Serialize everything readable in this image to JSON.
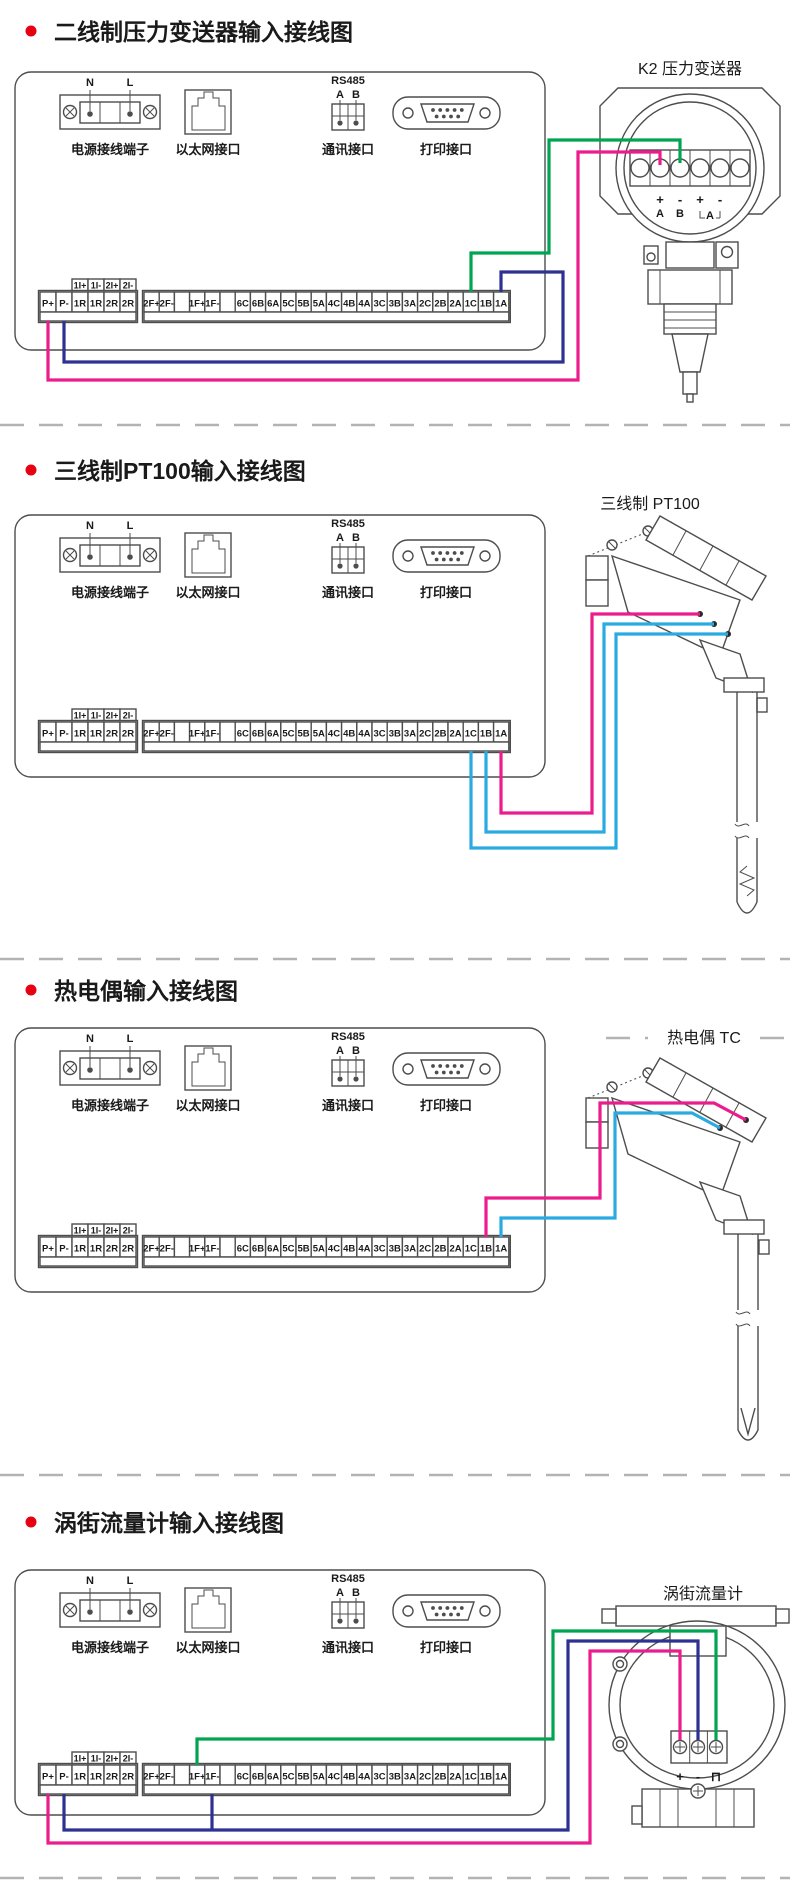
{
  "colors": {
    "magenta": "#ec1c8c",
    "blue": "#2e3192",
    "green": "#00a551",
    "cyan": "#29abe2",
    "bullet_red": "#e60012",
    "ink": "#4d4d4d"
  },
  "panel": {
    "power_label": "电源接线端子",
    "power_n": "N",
    "power_l": "L",
    "ethernet_label": "以太网接口",
    "rs485_title": "RS485",
    "rs485_a": "A",
    "rs485_b": "B",
    "comm_label": "通讯接口",
    "print_label": "打印接口"
  },
  "terminal_strip": {
    "top_cells": [
      "1I+",
      "1I-",
      "2I+",
      "2I-"
    ],
    "left_cells": [
      "P+",
      "P-",
      "1R",
      "1R",
      "2R",
      "2R"
    ],
    "right_cells": [
      "2F+",
      "2F-",
      "",
      "1F+",
      "1F-",
      "",
      "6C",
      "6B",
      "6A",
      "5C",
      "5B",
      "5A",
      "4C",
      "4B",
      "4A",
      "3C",
      "3B",
      "3A",
      "2C",
      "2B",
      "2A",
      "1C",
      "1B",
      "1A"
    ]
  },
  "sections": [
    {
      "title": "二线制压力变送器输入接线图",
      "device_label": "K2 压力变送器",
      "device_marks": [
        "+",
        "-",
        "+",
        "-",
        "A",
        "B",
        "A"
      ],
      "wires": [
        {
          "name": "wire-p-plus-to-transmitter",
          "color": "magenta",
          "from": "P+",
          "to": "+A",
          "points": [
            [
              48,
              321
            ],
            [
              48,
              380
            ],
            [
              578,
              380
            ],
            [
              578,
              152
            ],
            [
              660,
              152
            ],
            [
              660,
              165
            ]
          ]
        },
        {
          "name": "wire-transmitter-to-1c",
          "color": "green",
          "from": "1C",
          "to": "-B",
          "points": [
            [
              471,
              292
            ],
            [
              471,
              253
            ],
            [
              549,
              253
            ],
            [
              549,
              140
            ],
            [
              680,
              140
            ],
            [
              680,
              163
            ]
          ]
        },
        {
          "name": "wire-p-minus-to-1a",
          "color": "blue",
          "from": "P-",
          "to": "1A",
          "points": [
            [
              64,
              321
            ],
            [
              64,
              362
            ],
            [
              563,
              362
            ],
            [
              563,
              272
            ],
            [
              501,
              272
            ],
            [
              501,
              292
            ]
          ]
        }
      ]
    },
    {
      "title": "三线制PT100输入接线图",
      "device_label": "三线制  PT100",
      "wires": [
        {
          "name": "wire-1a-to-pt100",
          "color": "magenta",
          "from": "1A",
          "to": "PT100",
          "points": [
            [
              501,
              751
            ],
            [
              501,
              813
            ],
            [
              592,
              813
            ],
            [
              592,
              614
            ],
            [
              700,
              614
            ]
          ]
        },
        {
          "name": "wire-1b-to-pt100",
          "color": "cyan",
          "from": "1B",
          "to": "PT100",
          "points": [
            [
              486,
              751
            ],
            [
              486,
              832
            ],
            [
              604,
              832
            ],
            [
              604,
              624
            ],
            [
              714,
              624
            ]
          ]
        },
        {
          "name": "wire-1c-to-pt100",
          "color": "cyan",
          "from": "1C",
          "to": "PT100",
          "points": [
            [
              471,
              751
            ],
            [
              471,
              848
            ],
            [
              616,
              848
            ],
            [
              616,
              634
            ],
            [
              728,
              634
            ]
          ]
        }
      ]
    },
    {
      "title": "热电偶输入接线图",
      "device_label": "热电偶  TC",
      "wires": [
        {
          "name": "wire-1b-to-tc",
          "color": "magenta",
          "from": "1B",
          "to": "TC +",
          "points": [
            [
              486,
              1237
            ],
            [
              486,
              1198
            ],
            [
              600,
              1198
            ],
            [
              600,
              1103
            ],
            [
              714,
              1103
            ],
            [
              746,
              1120
            ]
          ]
        },
        {
          "name": "wire-1a-to-tc",
          "color": "cyan",
          "from": "1A",
          "to": "TC -",
          "points": [
            [
              501,
              1237
            ],
            [
              501,
              1218
            ],
            [
              615,
              1218
            ],
            [
              615,
              1113
            ],
            [
              692,
              1113
            ],
            [
              720,
              1128
            ]
          ]
        }
      ]
    },
    {
      "title": "涡街流量计输入接线图",
      "device_label": "涡街流量计",
      "device_marks": [
        "+",
        "-",
        "⊓"
      ],
      "wires": [
        {
          "name": "wire-1f-plus-to-flowmeter",
          "color": "green",
          "from": "1F+",
          "to": "⊓",
          "points": [
            [
              197,
              1765
            ],
            [
              197,
              1739
            ],
            [
              553,
              1739
            ],
            [
              553,
              1631
            ],
            [
              716,
              1631
            ],
            [
              716,
              1740
            ]
          ]
        },
        {
          "name": "wire-p-minus-to-flowmeter",
          "color": "blue",
          "from": "P-",
          "to": "-",
          "points": [
            [
              64,
              1794
            ],
            [
              64,
              1830
            ],
            [
              568,
              1830
            ],
            [
              568,
              1641
            ],
            [
              698,
              1641
            ],
            [
              698,
              1740
            ]
          ]
        },
        {
          "name": "wire-1f-minus-branch",
          "color": "blue",
          "from": "1F-",
          "to": "P- bus",
          "points": [
            [
              212,
              1794
            ],
            [
              212,
              1830
            ]
          ]
        },
        {
          "name": "wire-p-plus-to-flowmeter",
          "color": "magenta",
          "from": "P+",
          "to": "+",
          "points": [
            [
              48,
              1794
            ],
            [
              48,
              1843
            ],
            [
              590,
              1843
            ],
            [
              590,
              1651
            ],
            [
              680,
              1651
            ],
            [
              680,
              1740
            ]
          ]
        }
      ]
    }
  ]
}
